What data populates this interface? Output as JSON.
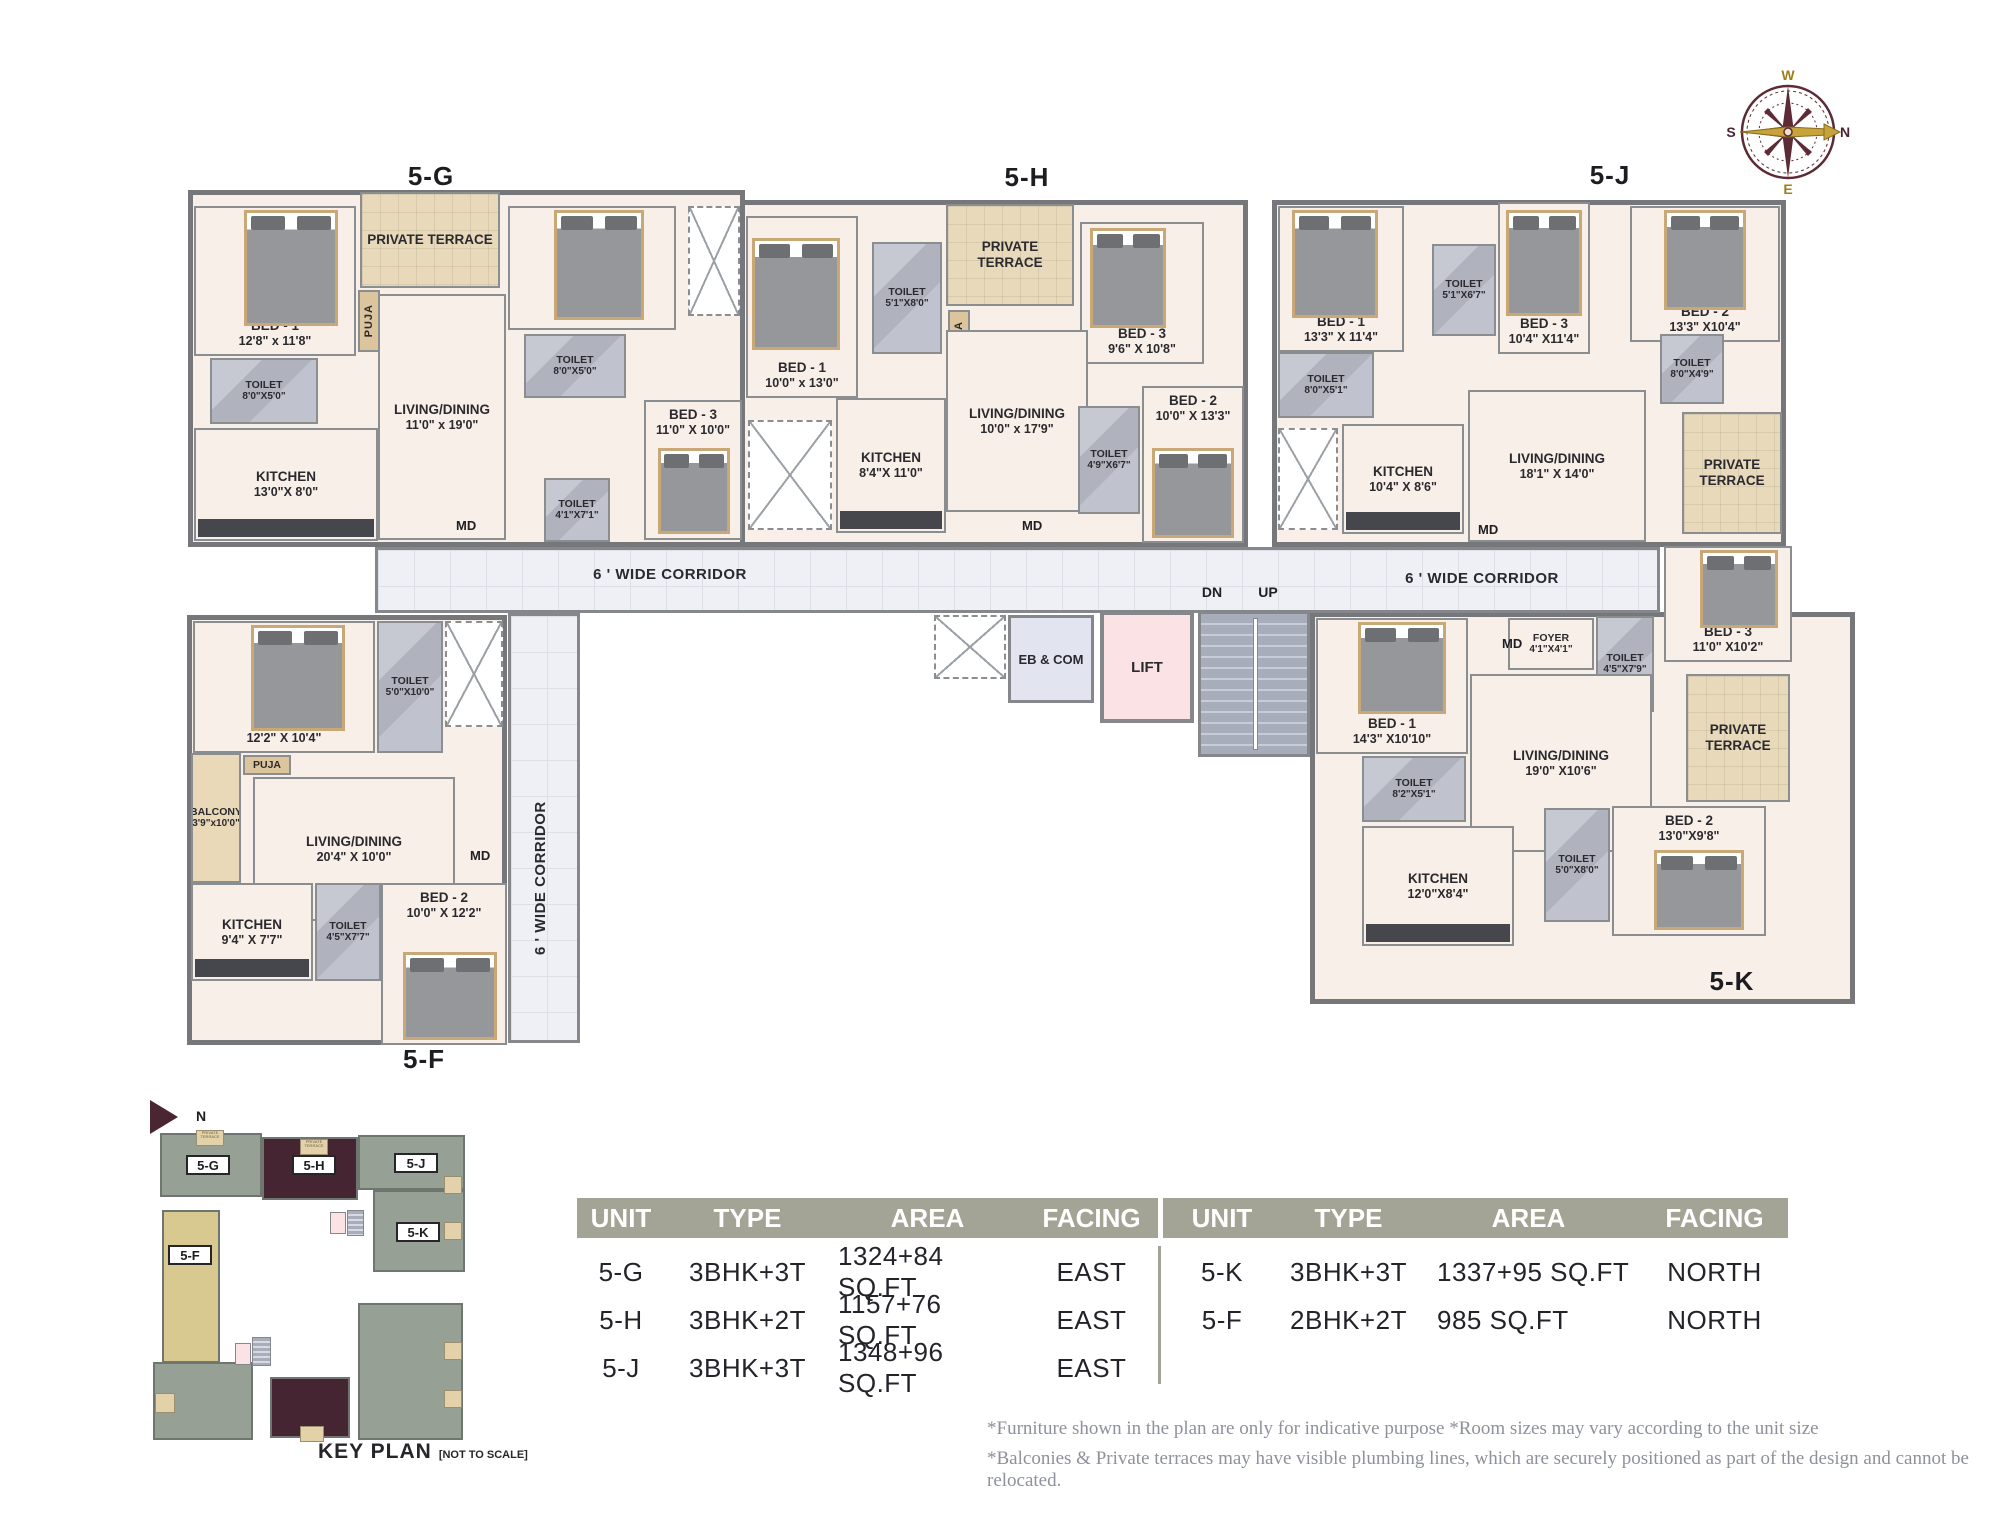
{
  "plan": {
    "labels": {
      "corridor": "6 ' WIDE CORRIDOR",
      "md": "MD",
      "dn": "DN",
      "up": "UP",
      "lift": "LIFT",
      "eb_com": "EB & COM"
    },
    "units": {
      "g": {
        "label": "5-G",
        "rooms": {
          "terrace": {
            "name": "PRIVATE TERRACE"
          },
          "bed1": {
            "name": "BED - 1",
            "dims": "12'8\" x 11'8\""
          },
          "bed2": {
            "name": "BED - 2",
            "dims": "13'3\" X 10'0\""
          },
          "bed3": {
            "name": "BED - 3",
            "dims": "11'0\" X 10'0\""
          },
          "toilet1": {
            "name": "TOILET",
            "dims": "8'0\"X5'0\""
          },
          "toilet2": {
            "name": "TOILET",
            "dims": "8'0\"X5'0\""
          },
          "toilet3": {
            "name": "TOILET",
            "dims": "4'1\"X7'1\""
          },
          "living": {
            "name": "LIVING/DINING",
            "dims": "11'0\" x 19'0\""
          },
          "kitchen": {
            "name": "KITCHEN",
            "dims": "13'0\"X 8'0\""
          },
          "puja": {
            "name": "PUJA"
          }
        }
      },
      "h": {
        "label": "5-H",
        "rooms": {
          "bed1": {
            "name": "BED - 1",
            "dims": "10'0\" x 13'0\""
          },
          "toilet1": {
            "name": "TOILET",
            "dims": "5'1\"X8'0\""
          },
          "terrace": {
            "name": "PRIVATE TERRACE"
          },
          "puja": {
            "name": "PUJA"
          },
          "bed3": {
            "name": "BED - 3",
            "dims": "9'6\" X 10'8\""
          },
          "living": {
            "name": "LIVING/DINING",
            "dims": "10'0\" x 17'9\""
          },
          "bed2": {
            "name": "BED - 2",
            "dims": "10'0\" X 13'3\""
          },
          "kitchen": {
            "name": "KITCHEN",
            "dims": "8'4\"X 11'0\""
          },
          "toilet2": {
            "name": "TOILET",
            "dims": "4'9\"X6'7\""
          }
        }
      },
      "j": {
        "label": "5-J",
        "rooms": {
          "bed1": {
            "name": "BED - 1",
            "dims": "13'3\" X 11'4\""
          },
          "toilet1": {
            "name": "TOILET",
            "dims": "5'1\"X6'7\""
          },
          "bed3": {
            "name": "BED - 3",
            "dims": "10'4\" X11'4\""
          },
          "bed2": {
            "name": "BED - 2",
            "dims": "13'3\" X10'4\""
          },
          "toilet2": {
            "name": "TOILET",
            "dims": "8'0\"X5'1\""
          },
          "toilet3": {
            "name": "TOILET",
            "dims": "8'0\"X4'9\""
          },
          "kitchen": {
            "name": "KITCHEN",
            "dims": "10'4\" X 8'6\""
          },
          "living": {
            "name": "LIVING/DINING",
            "dims": "18'1\" X 14'0\""
          },
          "terrace": {
            "name": "PRIVATE TERRACE"
          }
        }
      },
      "k": {
        "label": "5-K",
        "rooms": {
          "toilet1": {
            "name": "TOILET",
            "dims": "4'5\"X7'9\""
          },
          "foyer": {
            "name": "FOYER",
            "dims": "4'1\"X4'1\""
          },
          "bed3": {
            "name": "BED - 3",
            "dims": "11'0\" X10'2\""
          },
          "bed1": {
            "name": "BED - 1",
            "dims": "14'3\" X10'10\""
          },
          "toilet2": {
            "name": "TOILET",
            "dims": "8'2\"X5'1\""
          },
          "living": {
            "name": "LIVING/DINING",
            "dims": "19'0\" X10'6\""
          },
          "terrace": {
            "name": "PRIVATE TERRACE"
          },
          "toilet3": {
            "name": "TOILET",
            "dims": "5'0\"X8'0\""
          },
          "bed2": {
            "name": "BED - 2",
            "dims": "13'0\"X9'8\""
          },
          "kitchen": {
            "name": "KITCHEN",
            "dims": "12'0\"X8'4\""
          }
        }
      },
      "f": {
        "label": "5-F",
        "rooms": {
          "bed1": {
            "name": "BED - 1",
            "dims": "12'2\" X 10'4\""
          },
          "toilet1": {
            "name": "TOILET",
            "dims": "5'0\"X10'0\""
          },
          "puja": {
            "name": "PUJA"
          },
          "balcony": {
            "name": "BALCONY",
            "dims": "3'9\"x10'0\""
          },
          "living": {
            "name": "LIVING/DINING",
            "dims": "20'4\" X 10'0\""
          },
          "toilet2": {
            "name": "TOILET",
            "dims": "4'5\"X7'7\""
          },
          "kitchen": {
            "name": "KITCHEN",
            "dims": "9'4\" X 7'7\""
          },
          "bed2": {
            "name": "BED - 2",
            "dims": "10'0\" X 12'2\""
          }
        }
      }
    }
  },
  "compass": {
    "n": "N",
    "s": "S",
    "e": "E",
    "w": "W"
  },
  "key_plan": {
    "title": "KEY PLAN",
    "scale_note": "[NOT TO SCALE]",
    "north": "N",
    "terrace_label": "PRIVATE TERRACE",
    "units": {
      "g": "5-G",
      "h": "5-H",
      "j": "5-J",
      "k": "5-K",
      "f": "5-F"
    }
  },
  "tables": [
    {
      "headers": [
        "UNIT",
        "TYPE",
        "AREA",
        "FACING"
      ],
      "rows": [
        [
          "5-G",
          "3BHK+3T",
          "1324+84 SQ.FT",
          "EAST"
        ],
        [
          "5-H",
          "3BHK+2T",
          "1157+76 SQ.FT",
          "EAST"
        ],
        [
          "5-J",
          "3BHK+3T",
          "1348+96 SQ.FT",
          "EAST"
        ]
      ]
    },
    {
      "headers": [
        "UNIT",
        "TYPE",
        "AREA",
        "FACING"
      ],
      "rows": [
        [
          "5-K",
          "3BHK+3T",
          "1337+95 SQ.FT",
          "NORTH"
        ],
        [
          "5-F",
          "2BHK+2T",
          "985 SQ.FT",
          "NORTH"
        ]
      ]
    }
  ],
  "disclaimers": [
    "*Furniture shown in the plan are only for indicative purpose *Room sizes may vary according to the unit size",
    "*Balconies & Private terraces may have visible plumbing lines, which are securely positioned as part of the design and cannot be relocated."
  ]
}
